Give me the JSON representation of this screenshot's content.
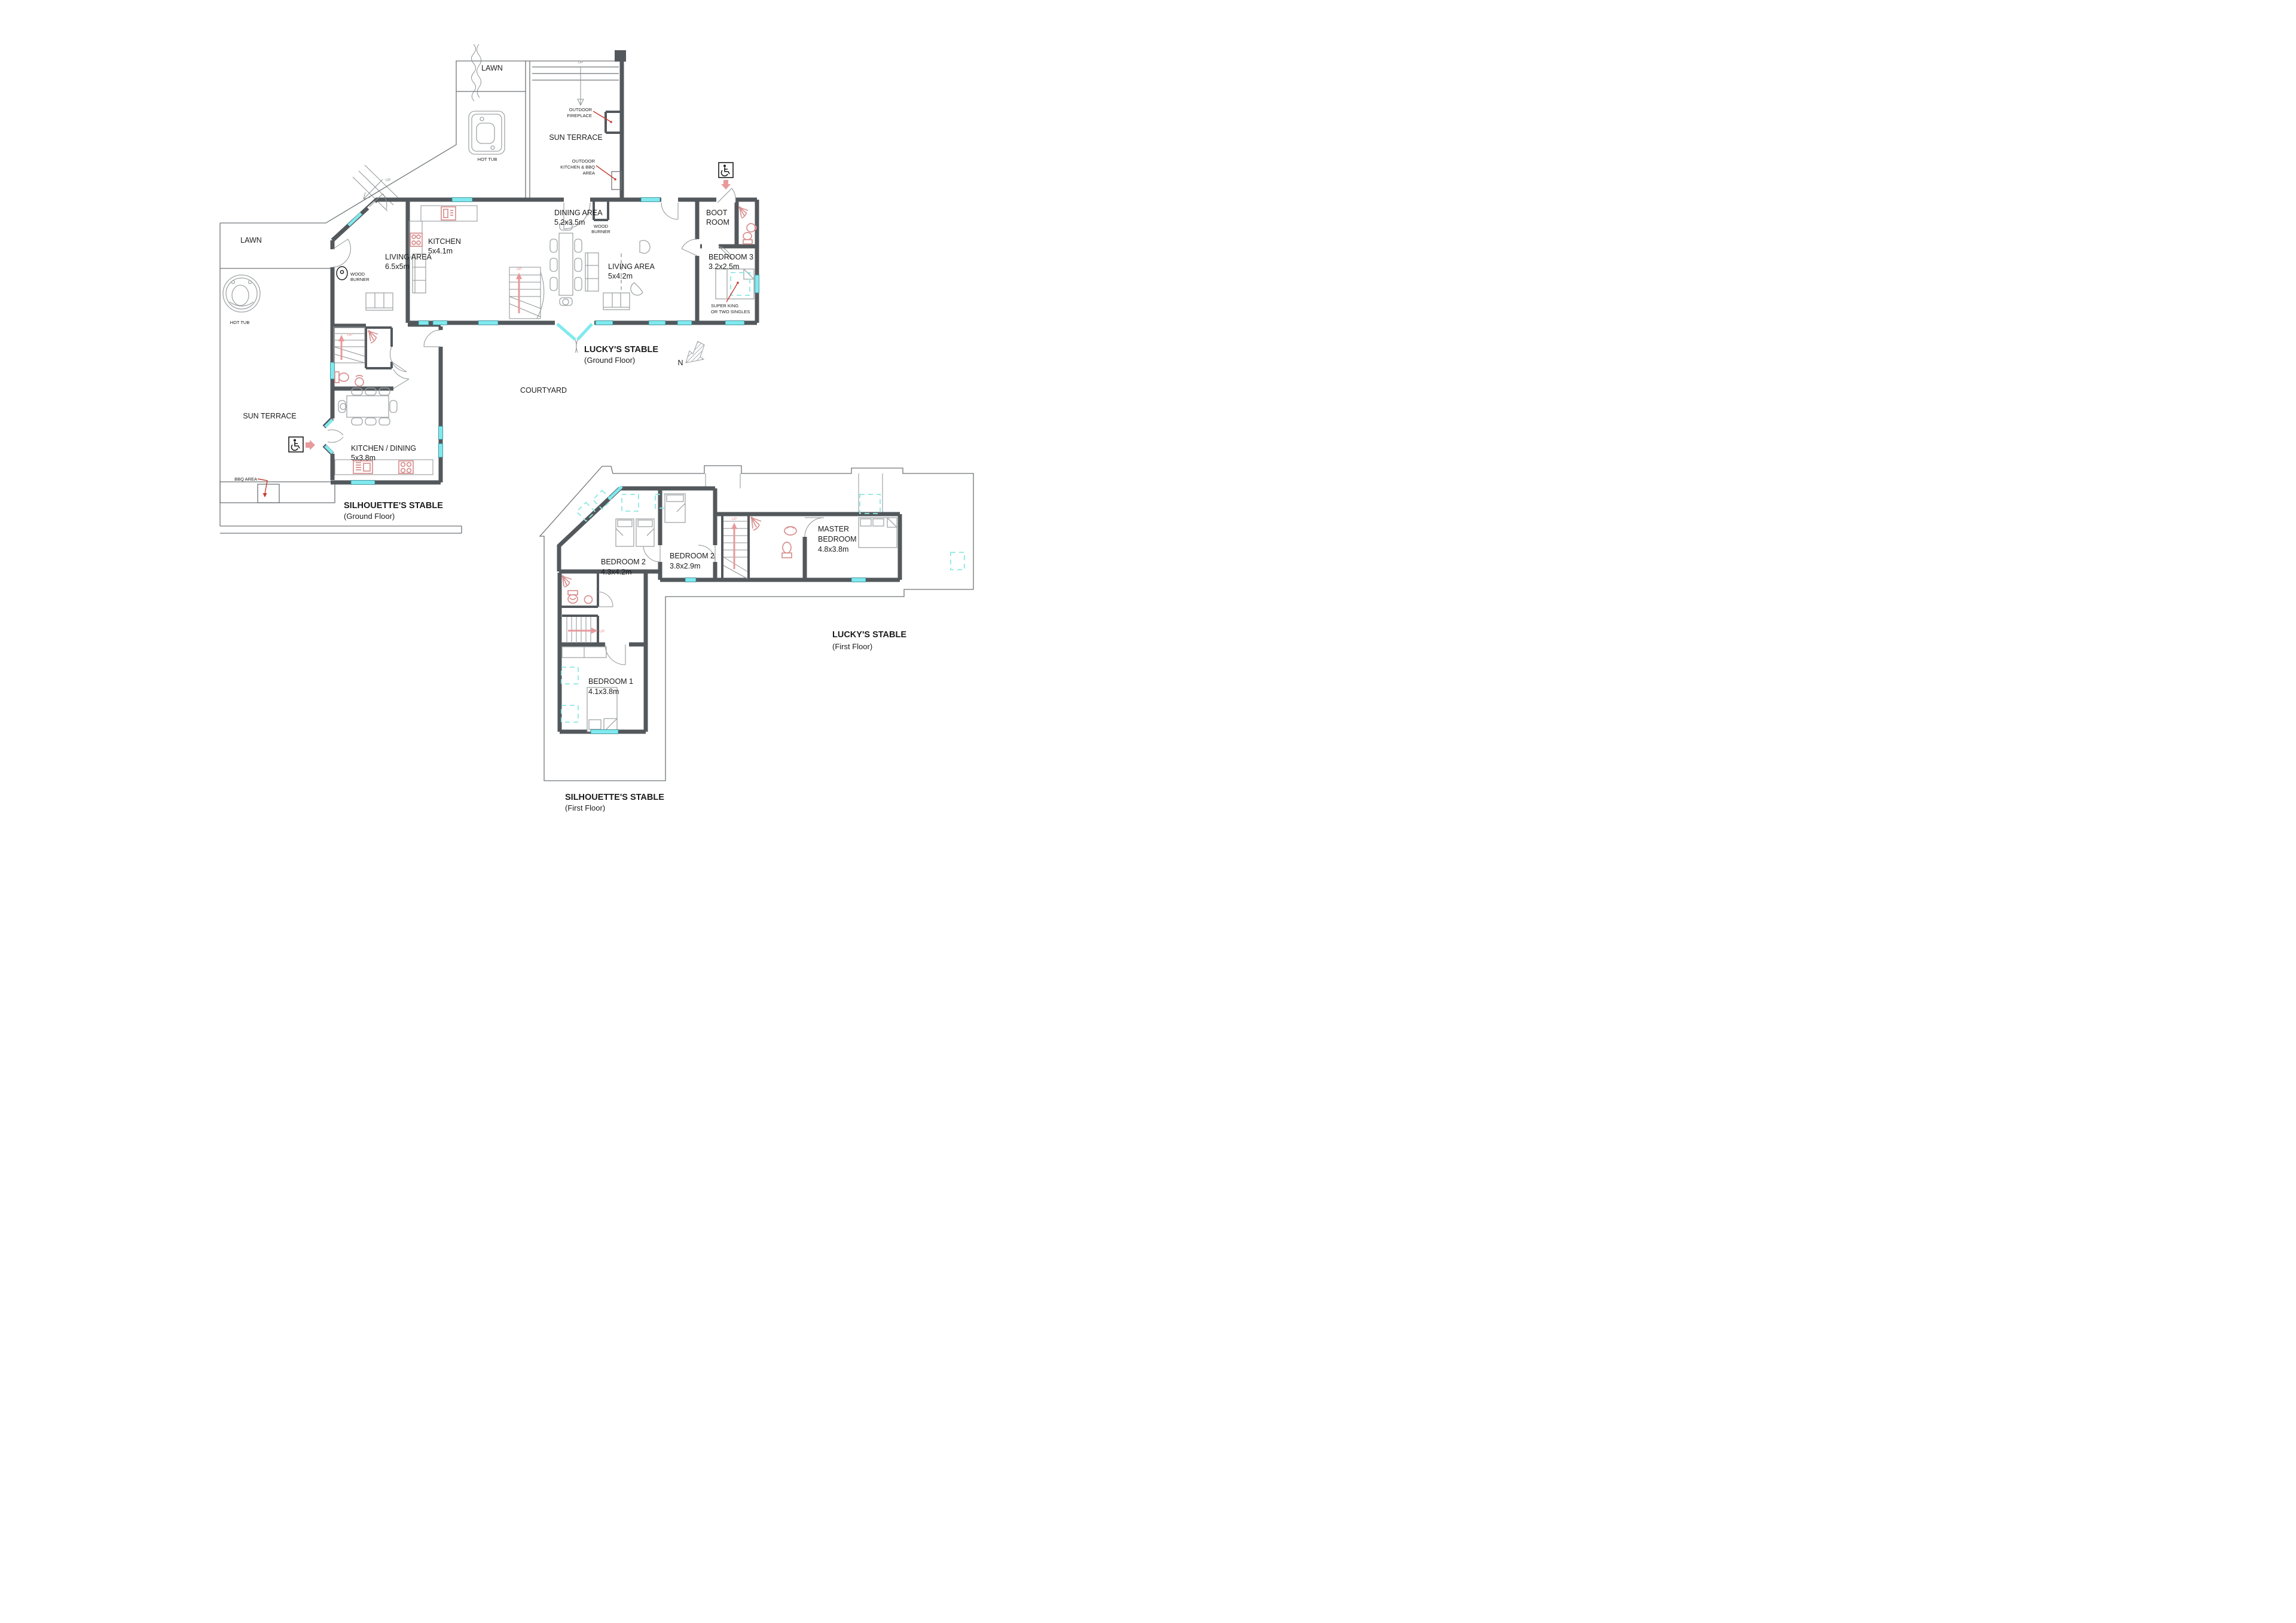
{
  "colors": {
    "wall": "#53585c",
    "window": "#7fe9ee",
    "roof_window_dashed": "#8ee8e2",
    "fixture_pink": "#d88f8f",
    "leader_red": "#c23b2f",
    "arrow_pink": "#e8999b",
    "outline_gray": "#6f7477",
    "text": "#1c1c1c"
  },
  "compass": {
    "label": "N"
  },
  "labels": {
    "courtyard": "COURTYARD",
    "up": "UP"
  },
  "ground_floor": {
    "luckys": {
      "title": "LUCKY'S STABLE",
      "subtitle": "(Ground Floor)"
    },
    "silhouettes": {
      "title": "SILHOUETTE'S STABLE",
      "subtitle": "(Ground Floor)"
    },
    "rooms": {
      "kitchen": {
        "name": "KITCHEN",
        "dims": "5x4.1m"
      },
      "dining": {
        "name": "DINING AREA",
        "dims": "5.2x3.5m"
      },
      "living_luckys": {
        "name": "LIVING AREA",
        "dims": "5x4.2m"
      },
      "living_silhouettes": {
        "name": "LIVING AREA",
        "dims": "6.5x5m"
      },
      "kitchen_dining": {
        "name": "KITCHEN / DINING",
        "dims": "5x3.8m"
      },
      "bedroom3": {
        "name": "BEDROOM 3",
        "dims": "3.2x2.5m"
      },
      "boot_room": {
        "line1": "BOOT",
        "line2": "ROOM"
      }
    },
    "outdoor": {
      "lawn_top": "LAWN",
      "lawn_left": "LAWN",
      "sun_terrace_top": "SUN TERRACE",
      "sun_terrace_left": "SUN TERRACE",
      "hot_tub_top": "HOT TUB",
      "hot_tub_left": "HOT TUB",
      "bbq_area": "BBQ AREA"
    },
    "annotations": {
      "outdoor_fireplace_line1": "OUTDOOR",
      "outdoor_fireplace_line2": "FIREPLACE",
      "outdoor_kitchen_line1": "OUTDOOR",
      "outdoor_kitchen_line2": "KITCHEN & BBQ",
      "outdoor_kitchen_line3": "AREA",
      "wood_burner_line1": "WOOD",
      "wood_burner_line2": "BURNER",
      "super_king_line1": "SUPER KING",
      "super_king_line2": "OR TWO SINGLES"
    }
  },
  "first_floor": {
    "luckys": {
      "title": "LUCKY'S STABLE",
      "subtitle": "(First Floor)"
    },
    "silhouettes": {
      "title": "SILHOUETTE'S STABLE",
      "subtitle": "(First Floor)"
    },
    "rooms": {
      "bedroom2a": {
        "name": "BEDROOM 2",
        "dims": "4.3x4.2m"
      },
      "bedroom2b": {
        "name": "BEDROOM 2",
        "dims": "3.8x2.9m"
      },
      "master": {
        "line1": "MASTER",
        "line2": "BEDROOM",
        "dims": "4.8x3.8m"
      },
      "bedroom1": {
        "name": "BEDROOM 1",
        "dims": "4.1x3.8m"
      }
    }
  }
}
